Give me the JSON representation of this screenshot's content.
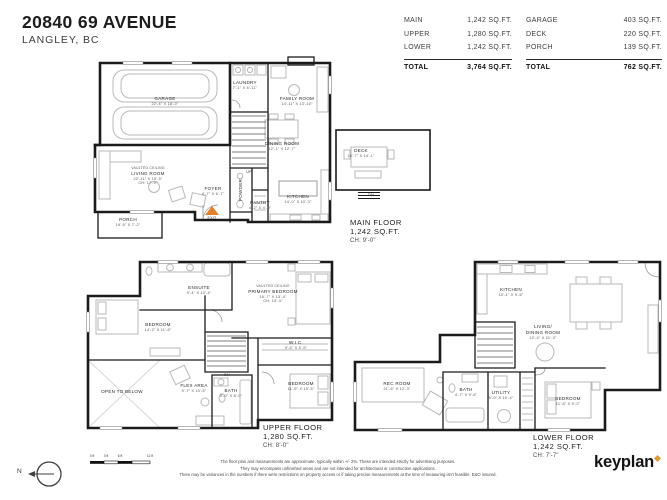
{
  "header": {
    "address": "20840 69 AVENUE",
    "city": "LANGLEY, BC"
  },
  "area_table": {
    "left": [
      {
        "label": "MAIN",
        "value": "1,242 SQ.FT."
      },
      {
        "label": "UPPER",
        "value": "1,280 SQ.FT."
      },
      {
        "label": "LOWER",
        "value": "1,242 SQ.FT."
      }
    ],
    "left_total": {
      "label": "TOTAL",
      "value": "3,764 SQ.FT."
    },
    "right": [
      {
        "label": "GARAGE",
        "value": "403 SQ.FT."
      },
      {
        "label": "DECK",
        "value": "220 SQ.FT."
      },
      {
        "label": "PORCH",
        "value": "139 SQ.FT."
      }
    ],
    "right_total": {
      "label": "TOTAL",
      "value": "762 SQ.FT."
    }
  },
  "floors": {
    "main": {
      "title": "MAIN FLOOR",
      "area": "1,242 SQ.FT.",
      "ceiling": "CH: 9'-0\"",
      "rooms": {
        "garage": {
          "name": "GARAGE",
          "dims": "22'-4\" X 18'-0\""
        },
        "laundry": {
          "name": "LAUNDRY",
          "dims": "7'-1\" X 6'-11\""
        },
        "family_room": {
          "name": "FAMILY ROOM",
          "dims": "14'-11\" X 13'-10\""
        },
        "dining_room": {
          "name": "DINING ROOM",
          "dims": "12'-1\" X 12'-7\""
        },
        "living_room": {
          "note": "VAULTED CEILING",
          "name": "LIVING ROOM",
          "dims": "22'-11\" X 15'-5\"",
          "extra": "CH: 17'-0\""
        },
        "foyer": {
          "name": "FOYER",
          "dims": "4'-7\" X 6'-7\""
        },
        "pantry": {
          "name": "PANTRY",
          "dims": "4'-2\" X 4'-0\""
        },
        "kitchen": {
          "name": "KITCHEN",
          "dims": "14'-0\" X 10'-3\""
        },
        "powder": {
          "name": "POWDER"
        },
        "porch": {
          "name": "PORCH",
          "dims": "19'-5\" X 7'-2\""
        },
        "deck": {
          "name": "DECK",
          "dims": "15'-7\" X 14'-1\""
        },
        "stairs_up": "UP",
        "stairs_dn": "DN",
        "exit": "EXIT"
      }
    },
    "upper": {
      "title": "UPPER FLOOR",
      "area": "1,280 SQ.FT.",
      "ceiling": "CH: 8'-0\"",
      "rooms": {
        "ensuite": {
          "name": "ENSUITE",
          "dims": "9'-4\" X 10'-4\""
        },
        "primary_bedroom": {
          "note": "VAULTED CEILING",
          "name": "PRIMARY BEDROOM",
          "dims": "16'-7\" X 13'-4\"",
          "extra": "CH: 10'-4\""
        },
        "bedroom_left": {
          "name": "BEDROOM",
          "dims": "14'-2\" X 11'-6\""
        },
        "open_to_below": {
          "name": "OPEN TO BELOW"
        },
        "flex_area": {
          "name": "FLEX AREA",
          "dims": "9'-7\" X 10'-5\""
        },
        "bath": {
          "name": "BATH",
          "dims": "5'-0\" X 8'-0\""
        },
        "wic": {
          "name": "W.I.C.",
          "dims": "9'-5\" X 5'-5\""
        },
        "bedroom_right": {
          "name": "BEDROOM",
          "dims": "11'-5\" X 10'-5\""
        },
        "stairs_dn": "DN"
      }
    },
    "lower": {
      "title": "LOWER FLOOR",
      "area": "1,242 SQ.FT.",
      "ceiling": "CH: 7'-7\"",
      "rooms": {
        "kitchen": {
          "name": "KITCHEN",
          "dims": "10'-1\" X 9'-6\""
        },
        "living_dining": {
          "name1": "LIVING/",
          "name2": "DINING ROOM",
          "dims": "12'-4\" X 21'-3\""
        },
        "rec_room": {
          "name": "REC ROOM",
          "dims": "21'-6\" X 12'-3\""
        },
        "bath": {
          "name": "BATH",
          "dims": "4'-7\" X 9'-6\""
        },
        "utility": {
          "name": "UTILITY",
          "dims": "5'-0\" X 10'-4\""
        },
        "bedroom": {
          "name": "BEDROOM",
          "dims": "11'-8\" X 9'-2\""
        }
      }
    }
  },
  "footer": {
    "north_label": "N",
    "scale_ticks": [
      "0 ft",
      "3 ft",
      "6 ft",
      "12 ft"
    ],
    "disclaimer": [
      "The floor plan and measurements are approximate, typically within +/- 2%. These are intended strictly for advertising purposes.",
      "They may encompass unfinished areas and are not intended for architectural or construction applications.",
      "There may be variances in the numbers if there were restrictions on property access or if taking precise measurements at the time of measuring isn't feasible. E&O insured."
    ],
    "logo": "keyplan"
  },
  "colors": {
    "wall": "#1b1b1b",
    "furniture": "#b9b9b9",
    "exit": "#e0812e",
    "brand": "#dd9b3f"
  }
}
